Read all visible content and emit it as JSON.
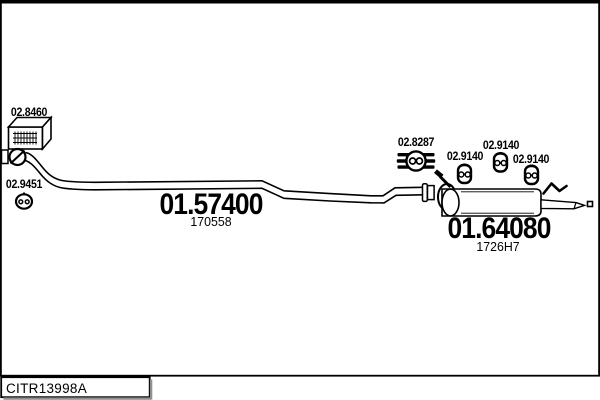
{
  "diagram": {
    "parts": [
      {
        "name": "flexible-section",
        "label": "02.8460"
      },
      {
        "name": "flange-gasket",
        "label": "02.9451"
      },
      {
        "name": "centre-pipe",
        "label": "01.57400",
        "sublabel": "170558"
      },
      {
        "name": "rubber-mount",
        "label": "02.8287"
      },
      {
        "name": "rubber-hanger-1",
        "label": "02.9140"
      },
      {
        "name": "rubber-hanger-2",
        "label": "02.9140"
      },
      {
        "name": "rubber-hanger-3",
        "label": "02.9140"
      },
      {
        "name": "rear-silencer",
        "label": "01.64080",
        "sublabel": "1726H7"
      }
    ],
    "icons": {
      "flexible-section": "hatched-3d-box-icon",
      "flange-gasket": "ring-with-slash-icon",
      "clamp": "ring-clamp-with-bolt-icon",
      "rubber-mount": "striped-mount-twin-holes-icon",
      "rubber-hanger": "block-twin-holes-icon"
    }
  },
  "footer": {
    "reference_code": "CITR13998A"
  },
  "colors": {
    "ink": "#000000",
    "background": "#ffffff",
    "box_shadow": "#909090"
  }
}
